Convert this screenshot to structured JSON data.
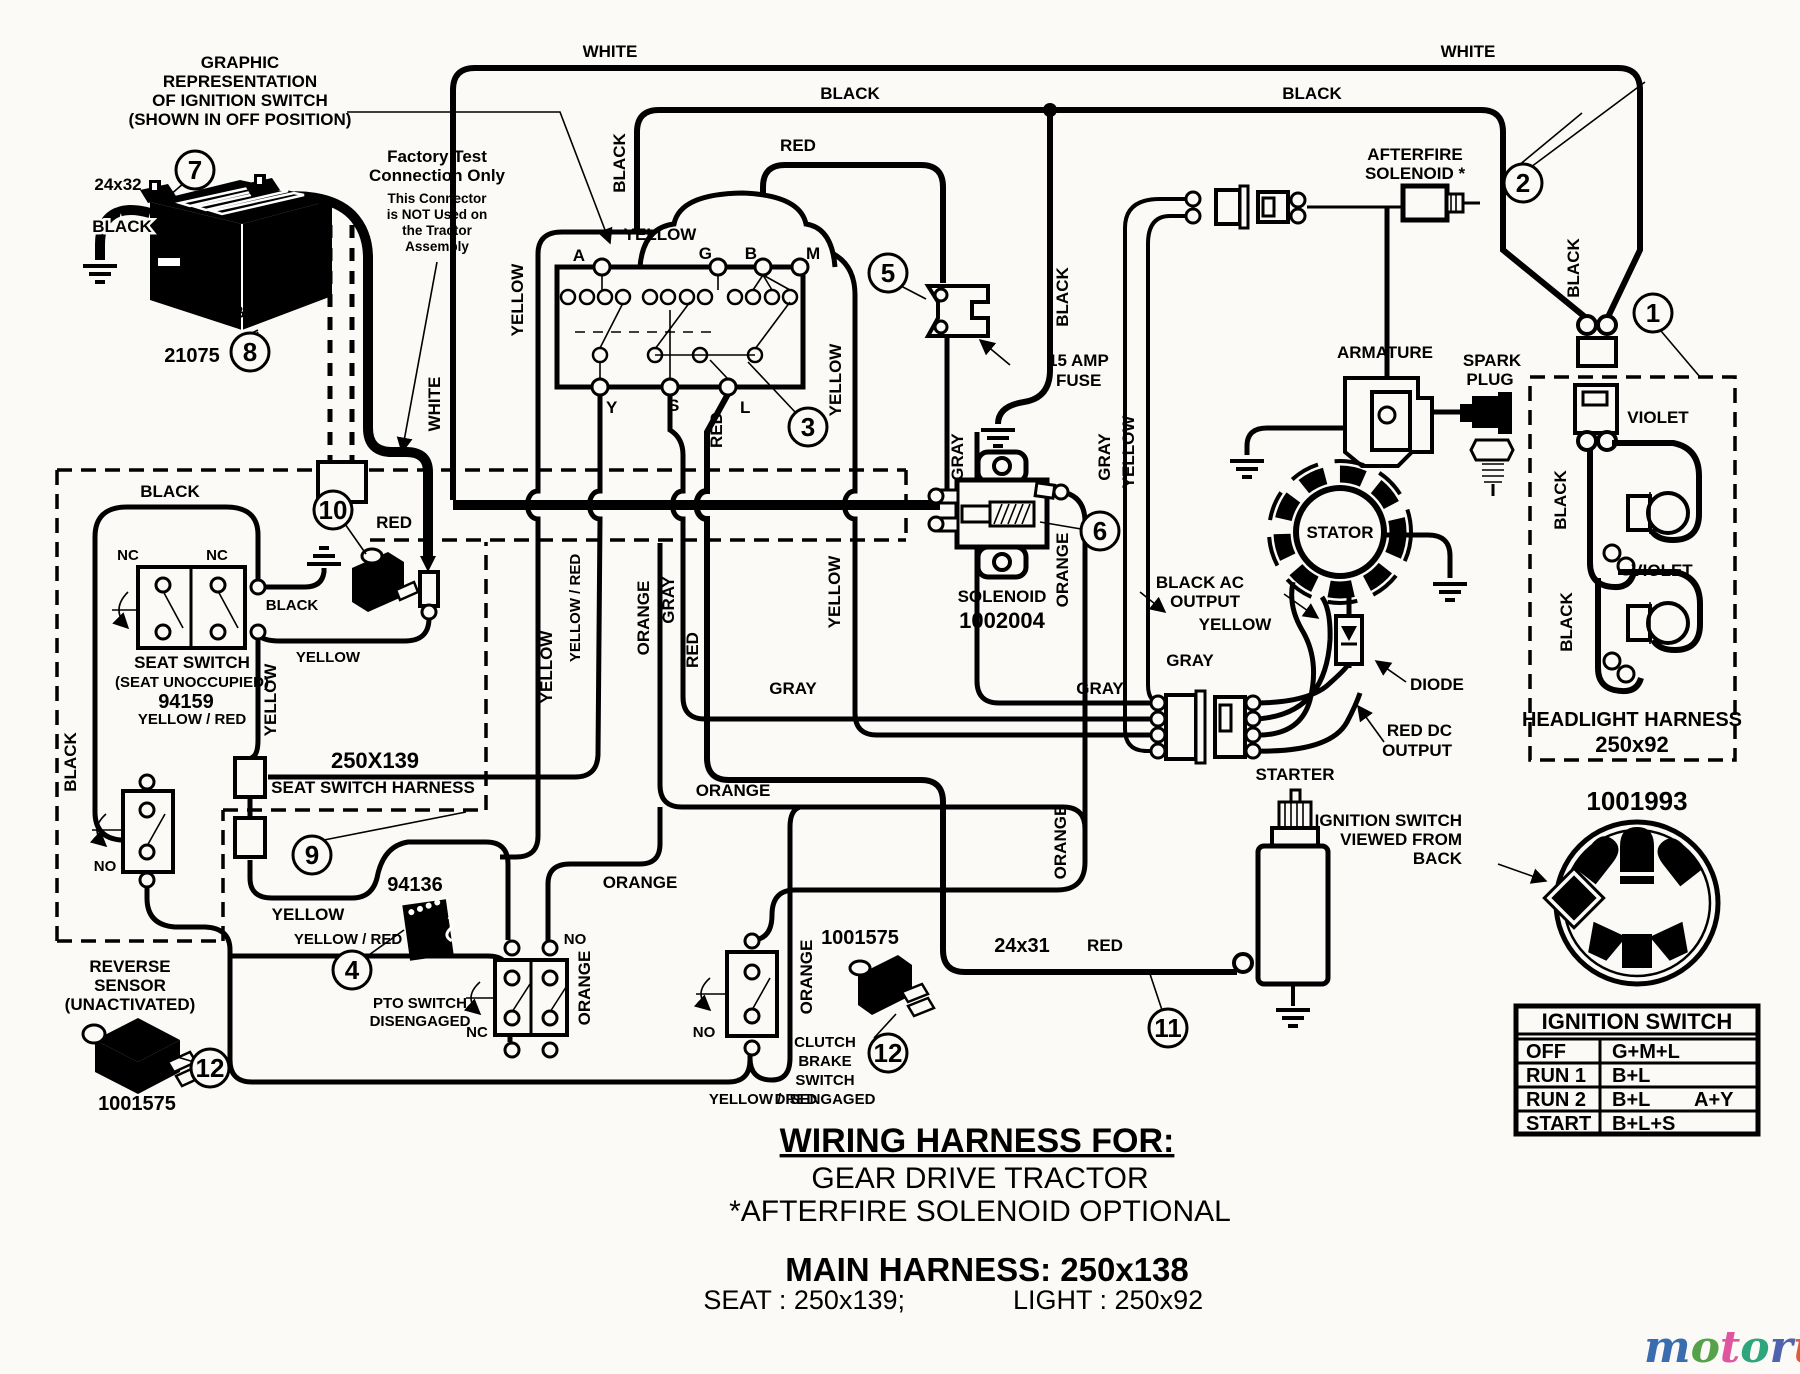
{
  "notes": {
    "graphic_rep": {
      "l1": "GRAPHIC",
      "l2": "REPRESENTATION",
      "l3": "OF  IGNITION  SWITCH",
      "l4": "(SHOWN  IN  OFF  POSITION)"
    },
    "factory": {
      "l1": "Factory Test",
      "l2": "Connection Only",
      "s1": "This Connector",
      "s2": "is NOT Used on",
      "s3": "the Tractor",
      "s4": "Assembly"
    }
  },
  "components": {
    "battery": {
      "name": "BATTERY",
      "part": "21075",
      "cable": "24x32"
    },
    "fuse": {
      "l1": "15 AMP",
      "l2": "FUSE"
    },
    "solenoid": {
      "name": "SOLENOID",
      "part": "1002004"
    },
    "afterfire": {
      "l1": "AFTERFIRE",
      "l2": "SOLENOID *"
    },
    "armature": "ARMATURE",
    "spark": {
      "l1": "SPARK",
      "l2": "PLUG"
    },
    "stator": "STATOR",
    "diode": "DIODE",
    "black_ac": {
      "l1": "BLACK AC",
      "l2": "OUTPUT"
    },
    "red_dc": {
      "l1": "RED DC",
      "l2": "OUTPUT"
    },
    "starter": "STARTER",
    "starter_cable": {
      "size": "24x31",
      "color": "RED"
    },
    "headlight": {
      "name": "HEADLIGHT HARNESS",
      "part": "250x92"
    },
    "seat_switch": {
      "l1": "SEAT SWITCH",
      "l2": "(SEAT UNOCCUPIED)",
      "part": "94159",
      "wire": "YELLOW / RED"
    },
    "seat_harness": {
      "part": "250X139",
      "name": "SEAT SWITCH HARNESS"
    },
    "reverse": {
      "l1": "REVERSE",
      "l2": "SENSOR",
      "l3": "(UNACTIVATED)",
      "part": "1001575"
    },
    "pto": {
      "part": "94136",
      "l1": "PTO SWITCH",
      "l2": "DISENGAGED"
    },
    "clutch": {
      "part": "1001575",
      "l1": "CLUTCH",
      "l2": "BRAKE",
      "l3": "SWITCH",
      "l4": "DISENGAGED"
    },
    "ign_view": {
      "l1": "IGNITION SWITCH",
      "l2": "VIEWED FROM",
      "l3": "BACK",
      "part": "1001993"
    }
  },
  "switch_terminals": {
    "a": "A",
    "g": "G",
    "b": "B",
    "m": "M",
    "y": "Y",
    "s": "S",
    "l": "L"
  },
  "connector_terminals": {
    "m": "M",
    "a": "A",
    "s": "S",
    "y": "Y",
    "g": "G",
    "l": "L",
    "b": "B"
  },
  "contacts": {
    "nc1": "NC",
    "nc2": "NC",
    "no_rev": "NO",
    "no_pto": "NO",
    "nc_pto": "NC",
    "no_clutch": "NO"
  },
  "ignition_table": {
    "title": "IGNITION SWITCH",
    "rows": [
      {
        "mode": "OFF",
        "circuit": "G+M+L",
        "extra": ""
      },
      {
        "mode": "RUN 1",
        "circuit": "B+L",
        "extra": ""
      },
      {
        "mode": "RUN 2",
        "circuit": "B+L",
        "extra": "A+Y"
      },
      {
        "mode": "START",
        "circuit": "B+L+S",
        "extra": ""
      }
    ]
  },
  "wires": {
    "top_white_l": "WHITE",
    "top_black_l": "BLACK",
    "top_red": "RED",
    "top_white_r": "WHITE",
    "top_black_r": "BLACK",
    "v_black_cloud": "BLACK",
    "yellow_cloud": "YELLOW",
    "v_yellow_a": "YELLOW",
    "v_white": "WHITE",
    "v_yellow_r1": "YELLOW",
    "v_yellow_r2": "YELLOW",
    "v_red_l": "RED",
    "v_yellow_535": "YELLOW",
    "v_yelred": "YELLOW / RED",
    "v_orange": "ORANGE",
    "v_gray": "GRAY",
    "v_red": "RED",
    "v_gray_sol": "GRAY",
    "v_gray_2": "GRAY",
    "v_yellow_conn": "YELLOW",
    "v_black_sol": "BLACK",
    "v_black_hl": "BLACK",
    "h_gray_1": "GRAY",
    "h_gray_2": "GRAY",
    "h_gray_3": "GRAY",
    "h_yellow_eng": "YELLOW",
    "v_orange_sol": "ORANGE",
    "v_orange_sol2": "ORANGE",
    "h_orange_1": "ORANGE",
    "h_orange_2": "ORANGE",
    "v_orange_pto": "ORANGE",
    "v_orange_cl": "ORANGE",
    "h_yellow_seat": "YELLOW",
    "h_yellow_seat2": "YELLOW",
    "h_black_seat1": "BLACK",
    "h_black_seat2": "BLACK",
    "cable_black": "BLACK",
    "v_black_seat": "BLACK",
    "v_yellow_box": "YELLOW",
    "h_yelred_1": "YELLOW / RED",
    "h_yelred_2": "YELLOW / RED",
    "red_conn": "RED",
    "violet1": "VIOLET",
    "violet2": "VIOLET",
    "black_b1": "BLACK",
    "black_b2": "BLACK"
  },
  "callouts": {
    "c1": "1",
    "c2": "2",
    "c3": "3",
    "c4": "4",
    "c5": "5",
    "c6": "6",
    "c7": "7",
    "c8": "8",
    "c9": "9",
    "c10": "10",
    "c11": "11",
    "c12": "12"
  },
  "footer": {
    "title": "WIRING HARNESS FOR:",
    "l1": "GEAR DRIVE TRACTOR",
    "l2": "*AFTERFIRE SOLENOID OPTIONAL",
    "main": "MAIN HARNESS: 250x138",
    "seat": "SEAT : 250x139;",
    "light": "LIGHT : 250x92"
  },
  "watermark": {
    "letters": [
      {
        "ch": "m",
        "c": "#3a6db0"
      },
      {
        "ch": "o",
        "c": "#55a24a"
      },
      {
        "ch": "t",
        "c": "#e0559f"
      },
      {
        "ch": "o",
        "c": "#2ea57c"
      },
      {
        "ch": "r",
        "c": "#4f63ae"
      },
      {
        "ch": "u",
        "c": "#e05a3a"
      },
      {
        "ch": "f",
        "c": "#eda325"
      }
    ],
    "suffix": ".de"
  }
}
